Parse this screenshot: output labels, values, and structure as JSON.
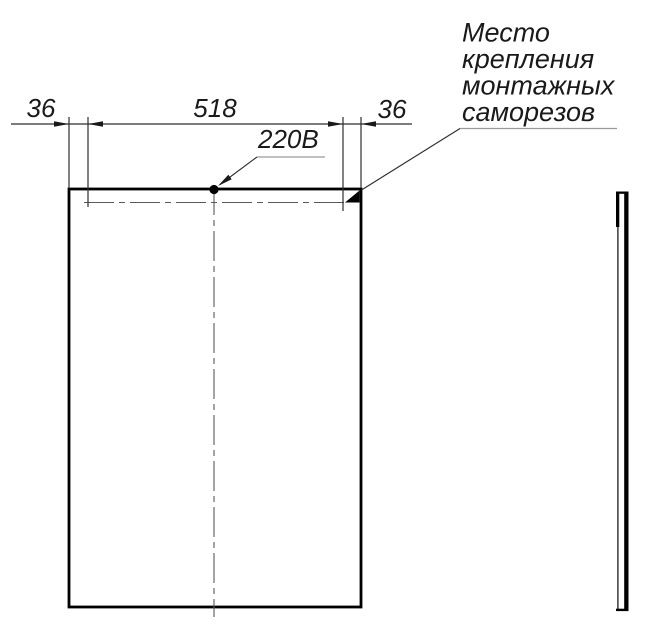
{
  "drawing": {
    "dimensions": {
      "left_offset": "36",
      "mounting_span": "518",
      "right_offset": "36"
    },
    "labels": {
      "power_supply": "220В"
    },
    "note": {
      "lines": [
        "Место",
        "крепления",
        "монтажных",
        "саморезов"
      ]
    },
    "colors": {
      "outline": "#000000",
      "thin_line": "#2e2e2e",
      "centerline": "#5a5a5a",
      "leader_underline": "#9a9a9a",
      "background": "#ffffff"
    }
  }
}
